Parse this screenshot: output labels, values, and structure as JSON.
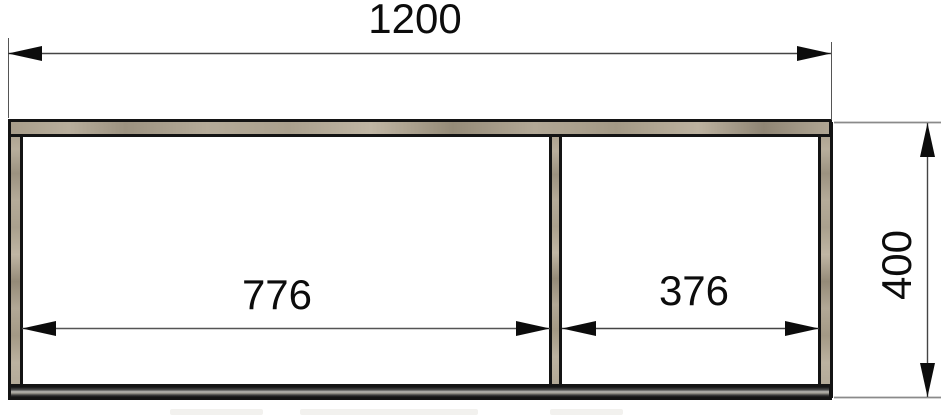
{
  "drawing": {
    "dimensions": {
      "overall_width": "1200",
      "left_opening": "776",
      "right_opening": "376",
      "overall_height": "400"
    },
    "colors": {
      "outline": "#141414",
      "wood_fill": "#b0a694",
      "metal_fill": "#9a988f",
      "dimension_line": "#666666",
      "background": "#ffffff"
    }
  }
}
